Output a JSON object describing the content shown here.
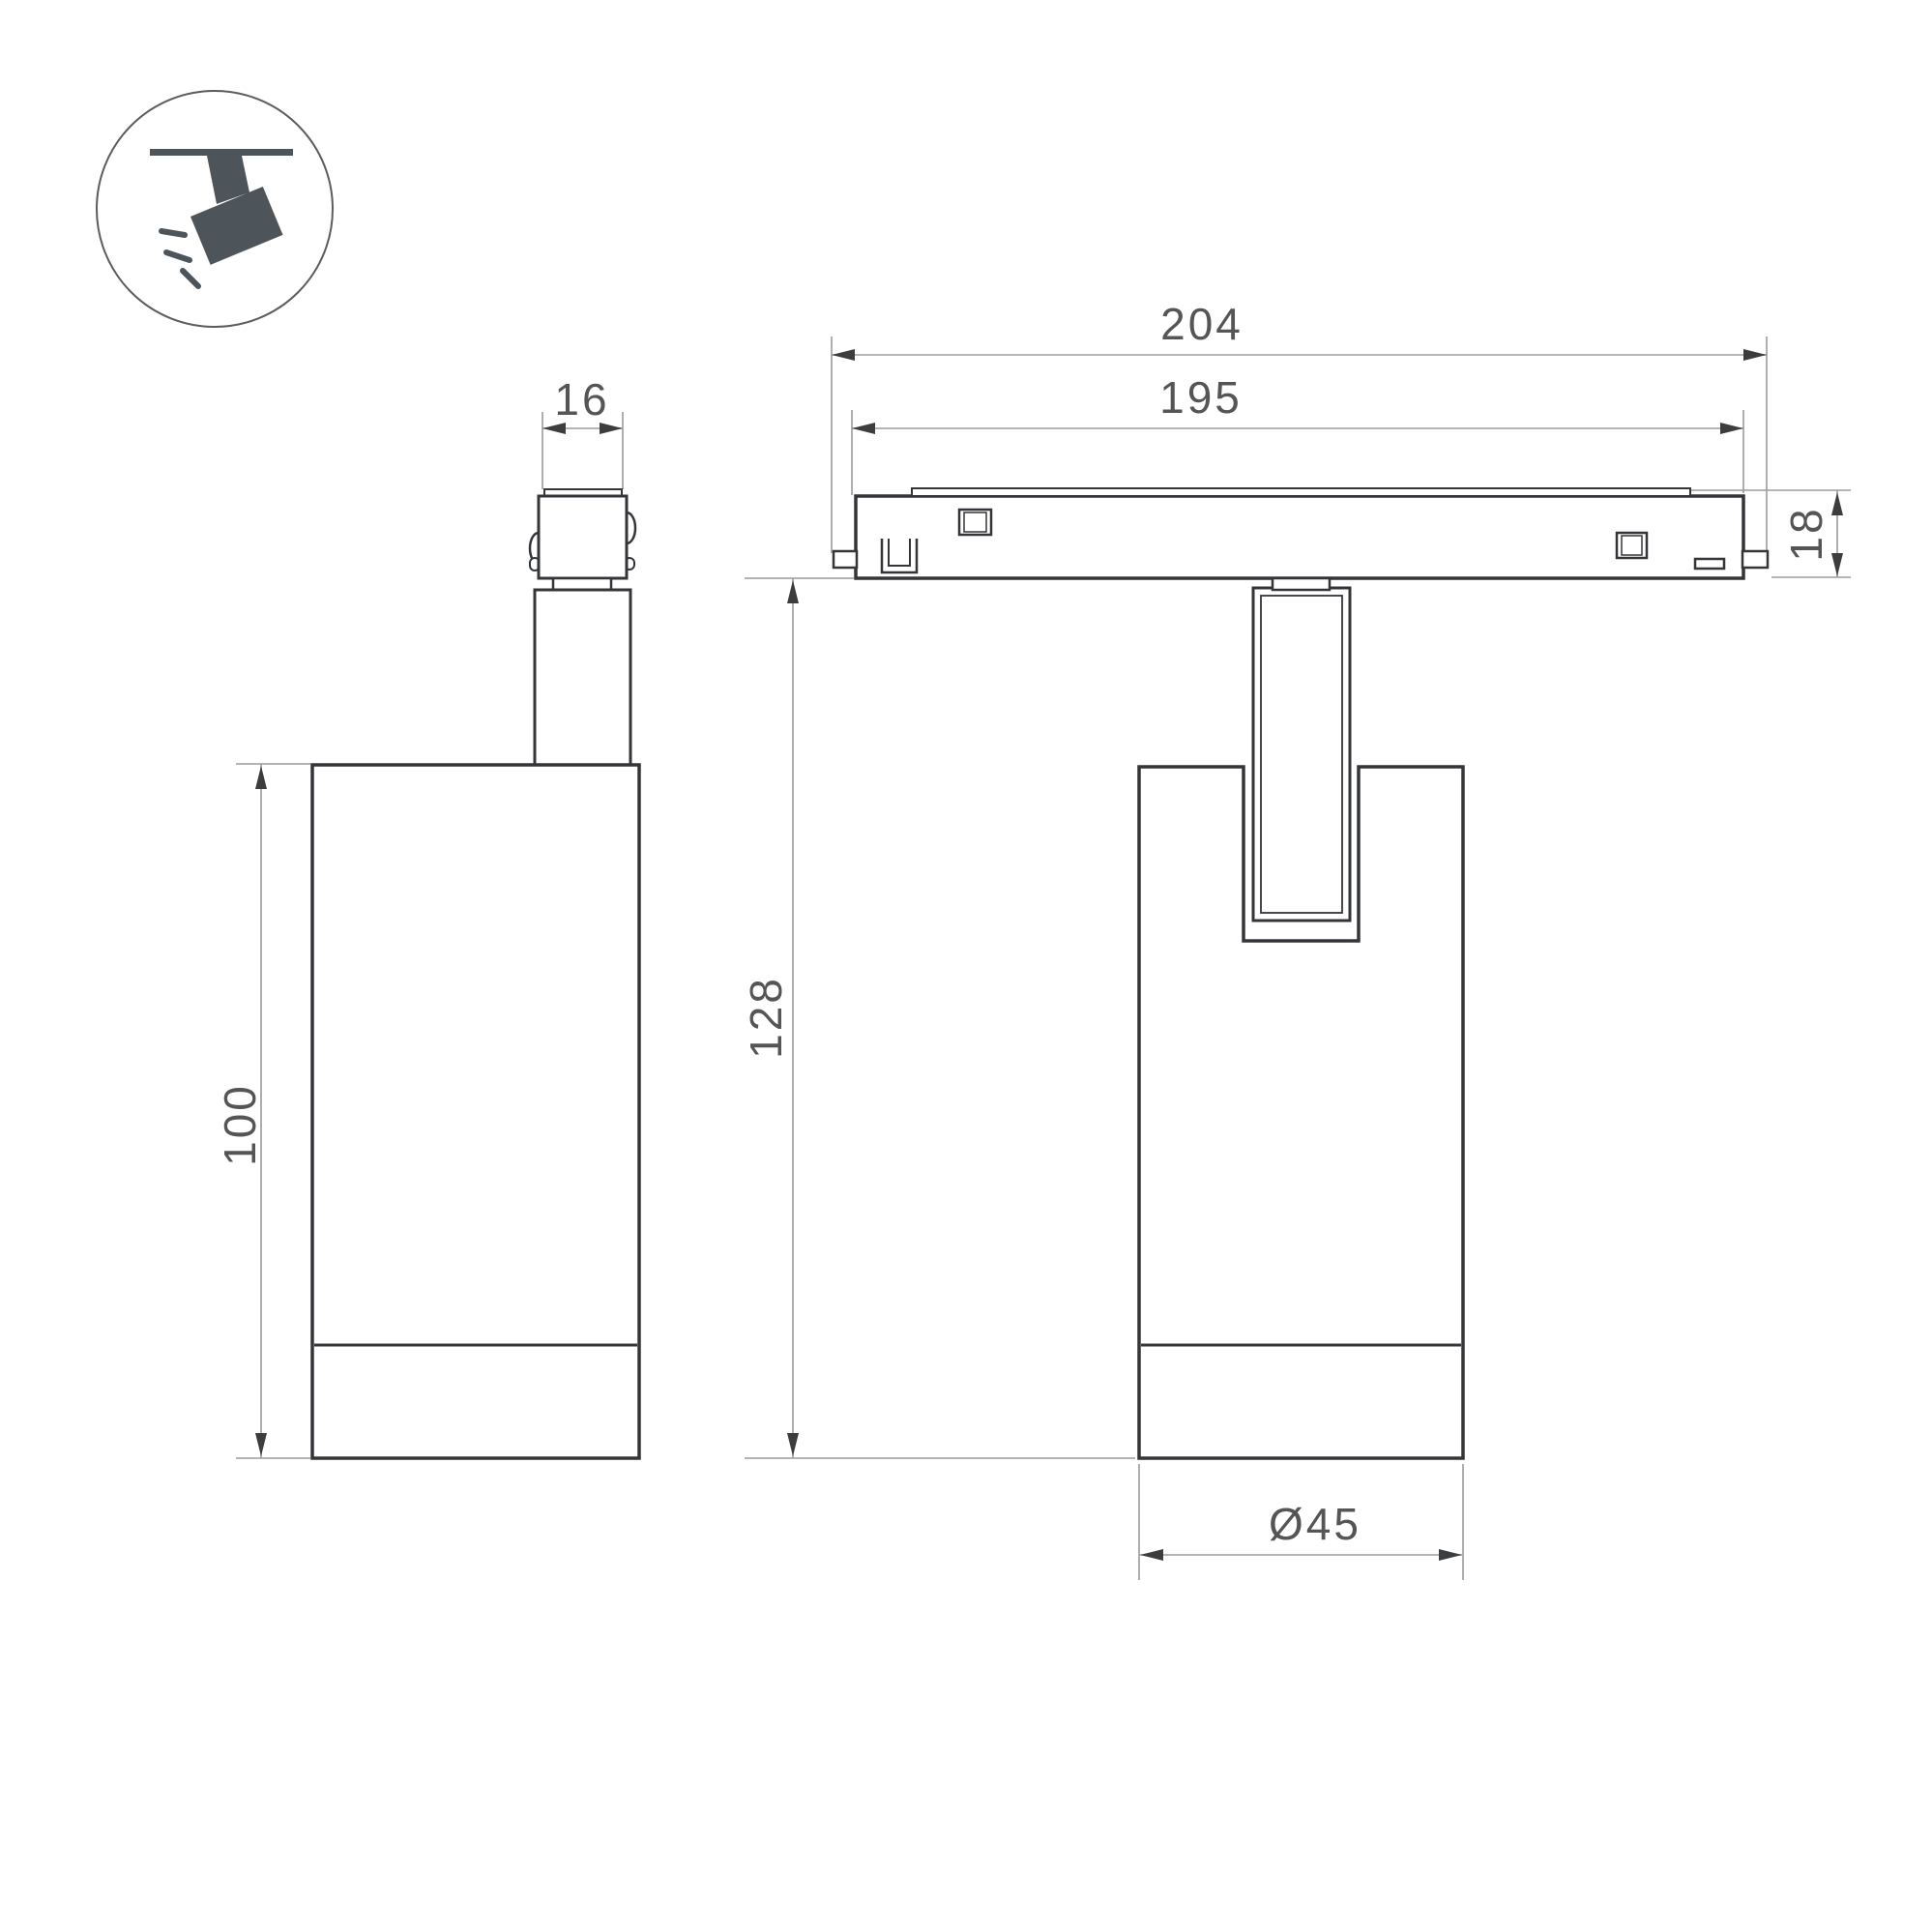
{
  "palette": {
    "background": "#ffffff",
    "outline": "#333538",
    "dim_line": "#9b9b9b",
    "dim_text": "#545557",
    "arrow": "#3b3d3f",
    "icon": "#4d545a",
    "icon_ring": "#5b5c5e"
  },
  "icon": {
    "name": "track-spotlight-pictogram"
  },
  "dimensions": {
    "adapter_width": "16",
    "track_length_outer": "204",
    "track_length_inner": "195",
    "track_height": "18",
    "overall_height": "128",
    "body_height": "100",
    "body_diameter": "Ø45"
  }
}
